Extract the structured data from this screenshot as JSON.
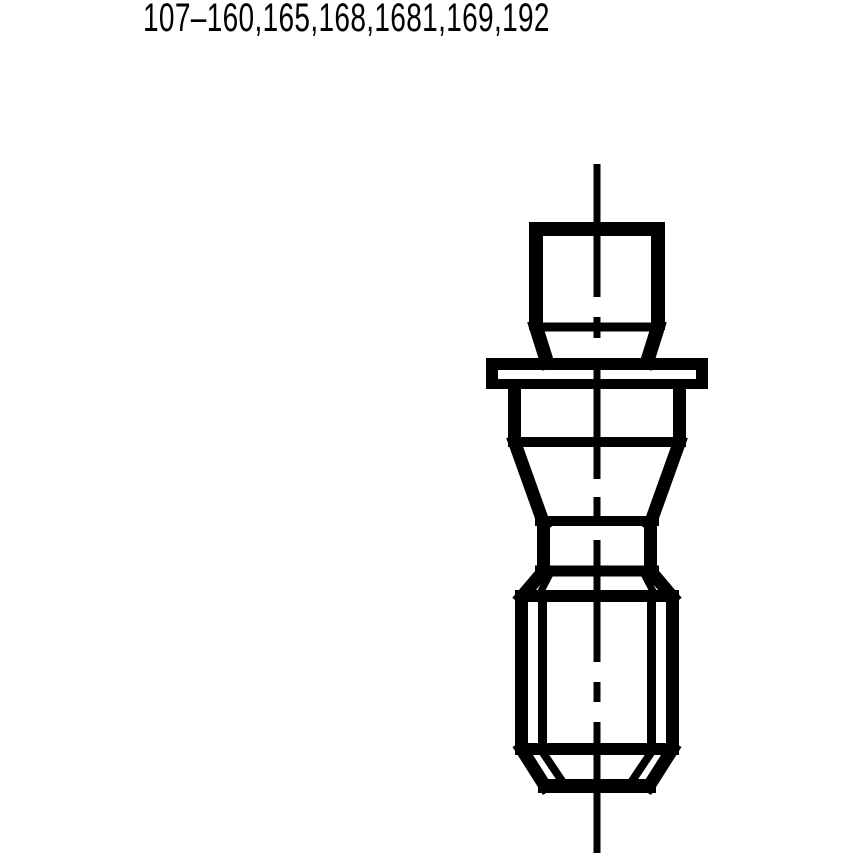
{
  "page": {
    "background": "#ffffff"
  },
  "header": {
    "part_numbers": "107–160,165,168,1681,169,192"
  },
  "drawing": {
    "kind": "threaded-stud-side-view",
    "line_color": "#000000",
    "fill_color": "#ffffff"
  }
}
